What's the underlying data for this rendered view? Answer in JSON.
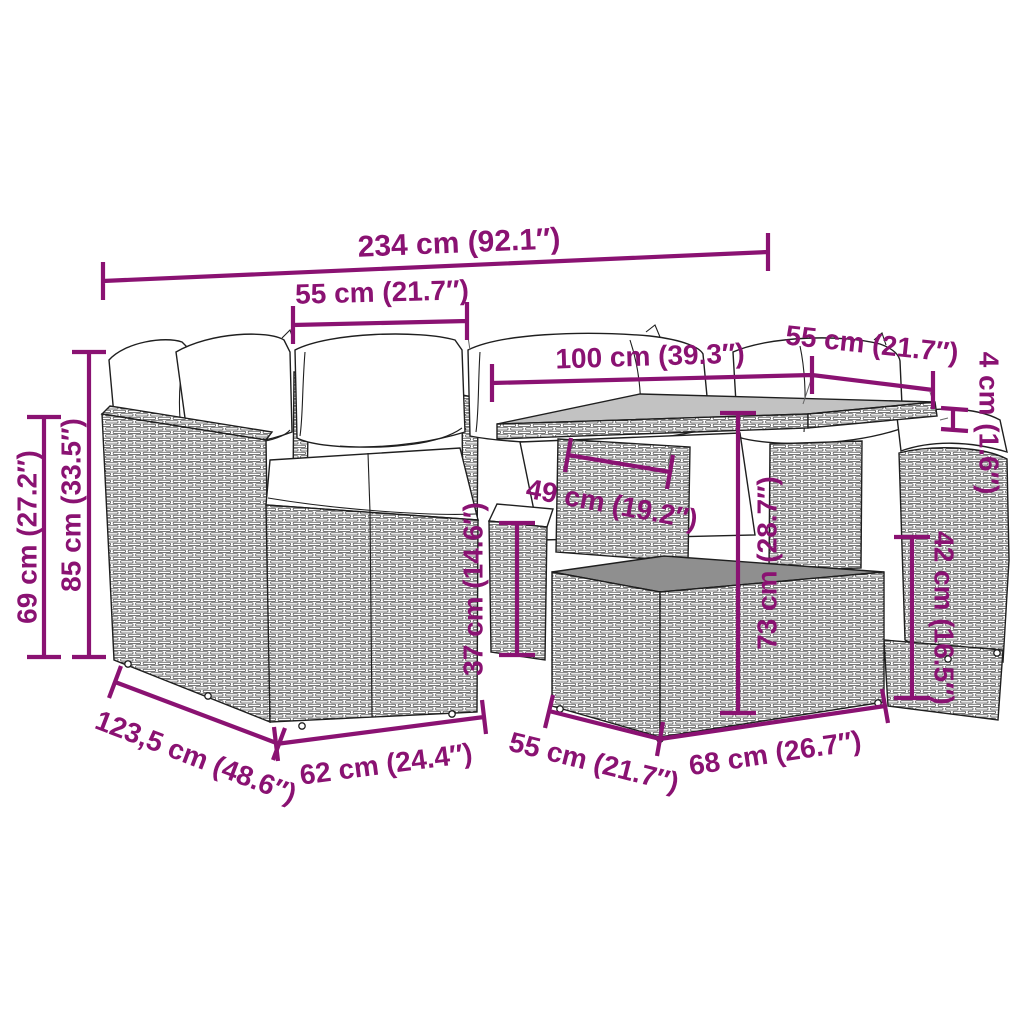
{
  "diagram": {
    "type": "product-dimension-drawing",
    "subject": "rattan-garden-lounge-set-with-table-and-cushions",
    "colors": {
      "accent-color": "#8A1272",
      "drawing-color": "#1f1f1f",
      "tabletop-color": "#c2c2c2",
      "base-band-color": "#8f8f8f",
      "bg-color": "#ffffff"
    },
    "dimensions": [
      {
        "id": "overall-width",
        "label": "234 cm (92.1″)"
      },
      {
        "id": "seat-width",
        "label": "55 cm (21.7″)"
      },
      {
        "id": "table-length",
        "label": "100 cm (39.3″)"
      },
      {
        "id": "table-width",
        "label": "55 cm (21.7″)"
      },
      {
        "id": "tabletop-thickness",
        "label": "4 cm (1.6″)"
      },
      {
        "id": "armrest-height",
        "label": "69 cm (27.2″)"
      },
      {
        "id": "backrest-height",
        "label": "85 cm (33.5″)"
      },
      {
        "id": "table-clearance",
        "label": "49 cm (19.2″)"
      },
      {
        "id": "footstool-height",
        "label": "37 cm (14.6″)"
      },
      {
        "id": "table-height",
        "label": "73 cm (28.7″)"
      },
      {
        "id": "table-base-height",
        "label": "42 cm (16.5″)"
      },
      {
        "id": "sofa-depth",
        "label": "123,5 cm (48.6″)"
      },
      {
        "id": "seat-depth",
        "label": "62 cm (24.4″)"
      },
      {
        "id": "table-base-depth",
        "label": "55 cm (21.7″)"
      },
      {
        "id": "table-base-width",
        "label": "68 cm (26.7″)"
      }
    ]
  }
}
